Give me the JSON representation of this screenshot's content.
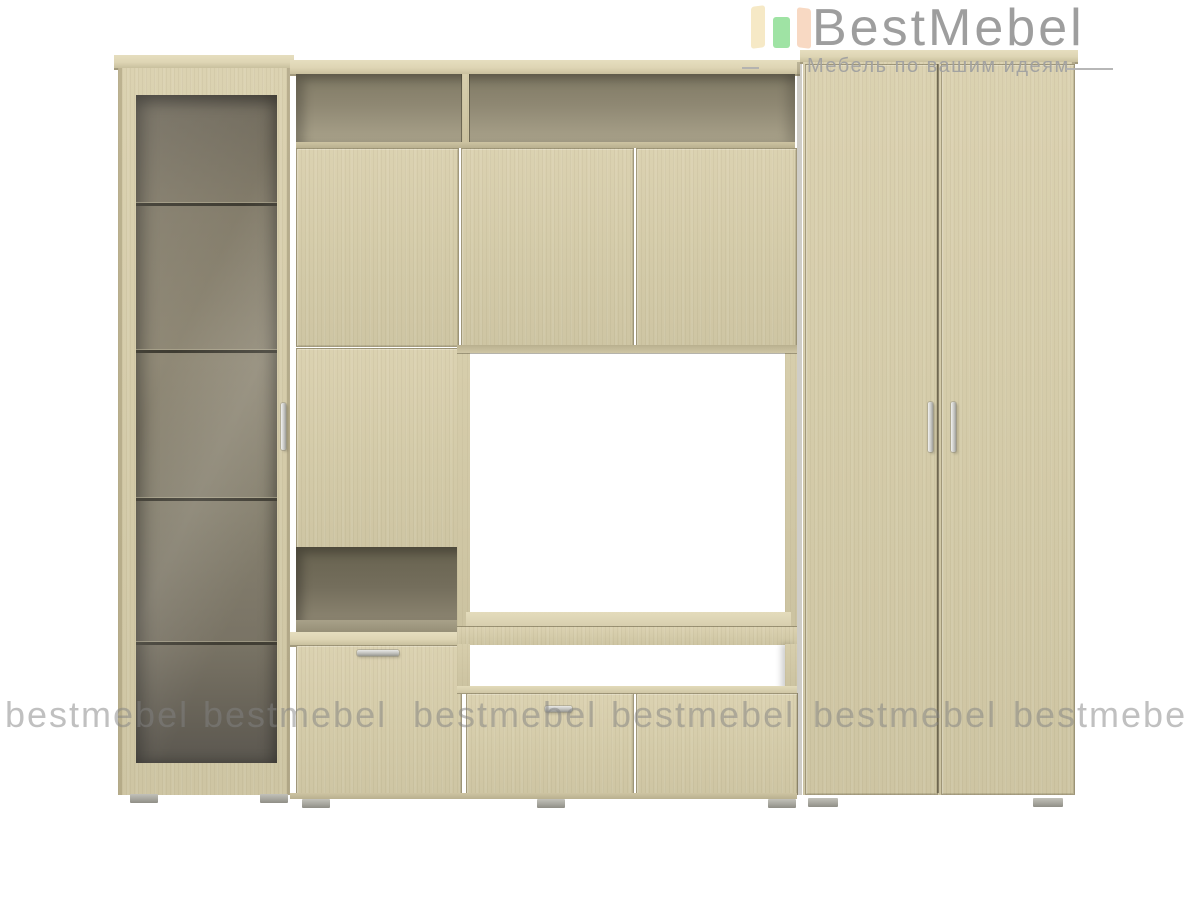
{
  "brand": {
    "logo_text": "BestMebel",
    "tagline": "Мебель по вашим идеям",
    "logo_icon": "open-wardrobe-icon",
    "colors": {
      "logo_text": "#969696",
      "tagline": "#a0a0a0",
      "icon_left_panel": "#f6e9c6",
      "icon_middle_panel": "#9fe3a4",
      "icon_right_panel": "#f8d9c3"
    }
  },
  "watermark": {
    "text": "bestmebel",
    "count": 6,
    "color": "#828282"
  },
  "product": {
    "type": "furniture-render",
    "description": "wall unit with display cabinet, tv niche and wardrobe",
    "wood_color": "#d6cdaa",
    "interior_color": "#7e7868",
    "handle_color": "#c6c6c2",
    "components": [
      "glass-display-cabinet",
      "open-top-shelf",
      "upper-cabinet-doors",
      "side-cabinet-door",
      "open-niche",
      "lower-flap-cabinet",
      "tv-niche",
      "tv-stand-drawers",
      "two-door-wardrobe"
    ]
  }
}
